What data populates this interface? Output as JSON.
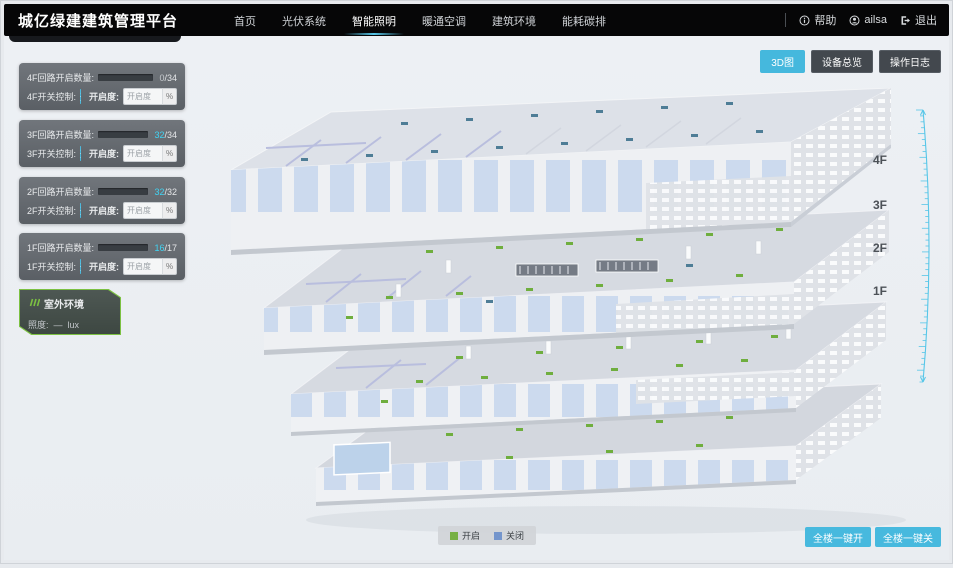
{
  "header": {
    "title": "城亿绿建建筑管理平台",
    "nav": [
      {
        "label": "首页",
        "active": false
      },
      {
        "label": "光伏系统",
        "active": false
      },
      {
        "label": "智能照明",
        "active": true
      },
      {
        "label": "暖通空调",
        "active": false
      },
      {
        "label": "建筑环境",
        "active": false
      },
      {
        "label": "能耗碳排",
        "active": false
      }
    ],
    "help_label": "帮助",
    "username": "ailsa",
    "logout_label": "退出"
  },
  "toolbar": {
    "view3d_label": "3D图",
    "device_overview_label": "设备总览",
    "operation_log_label": "操作日志"
  },
  "ui": {
    "slash": "/"
  },
  "floor_panels": [
    {
      "count_label": "4F回路开启数量:",
      "on": "0",
      "total": "34",
      "progress": 0,
      "num_style": "color:#c6cace",
      "switch_label": "4F开关控制:",
      "btn_on": "开",
      "btn_off": "关",
      "opening_label": "开启度:",
      "opening_placeholder": "开启度",
      "unit": "%"
    },
    {
      "count_label": "3F回路开启数量:",
      "on": "32",
      "total": "34",
      "progress": 94,
      "num_style": "color:#3fd4f4",
      "switch_label": "3F开关控制:",
      "btn_on": "开",
      "btn_off": "关",
      "opening_label": "开启度:",
      "opening_placeholder": "开启度",
      "unit": "%"
    },
    {
      "count_label": "2F回路开启数量:",
      "on": "32",
      "total": "32",
      "progress": 100,
      "num_style": "color:#3fd4f4",
      "switch_label": "2F开关控制:",
      "btn_on": "开",
      "btn_off": "关",
      "opening_label": "开启度:",
      "opening_placeholder": "开启度",
      "unit": "%"
    },
    {
      "count_label": "1F回路开启数量:",
      "on": "16",
      "total": "17",
      "progress": 94,
      "num_style": "color:#3fd4f4",
      "switch_label": "1F开关控制:",
      "btn_on": "开",
      "btn_off": "关",
      "opening_label": "开启度:",
      "opening_placeholder": "开启度",
      "unit": "%"
    }
  ],
  "outdoor": {
    "title": "室外环境",
    "metric_label": "照度:",
    "value": "—",
    "unit": "lux"
  },
  "floor_labels": [
    "4F",
    "3F",
    "2F",
    "1F"
  ],
  "legend": {
    "on_label": "开启",
    "off_label": "关闭",
    "on_color": "#76b043",
    "off_color": "#7495cc"
  },
  "bulk_actions": {
    "all_on": "全楼一键开",
    "all_off": "全楼一键关"
  },
  "colors": {
    "accent": "#45b8dd",
    "ruler": "#56c6e8",
    "light_on": "#6fae3e",
    "light_off": "#4e7d96"
  }
}
